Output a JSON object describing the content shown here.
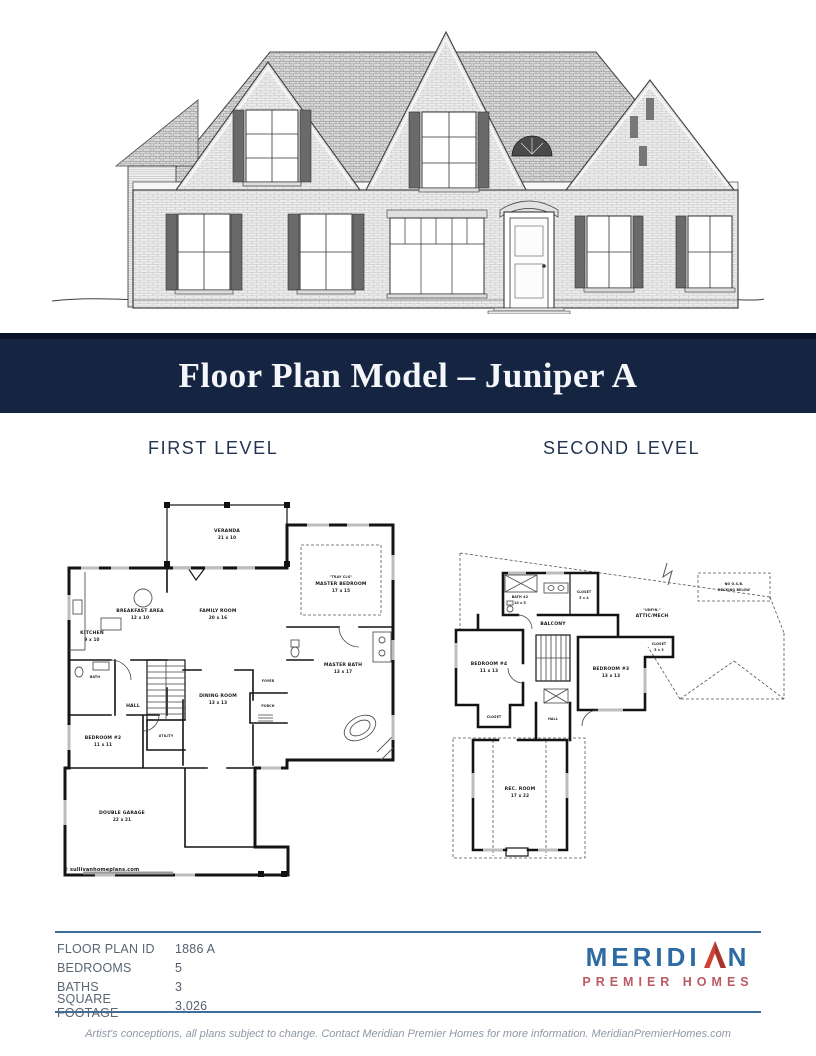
{
  "banner": {
    "title": "Floor Plan Model – Juniper A"
  },
  "section_labels": {
    "first": "FIRST LEVEL",
    "second": "SECOND LEVEL"
  },
  "first_level": {
    "rooms": [
      {
        "name": "VERANDA",
        "dims": "21 x 10"
      },
      {
        "name": "BREAKFAST AREA",
        "dims": "12 x 10"
      },
      {
        "name": "KITCHEN",
        "dims": "9 x 10"
      },
      {
        "name": "FAMILY ROOM",
        "dims": "20 x 16"
      },
      {
        "note": "\"TRAY CLG\"",
        "name": "MASTER BEDROOM",
        "dims": "17 x 15"
      },
      {
        "name": "MASTER BATH",
        "dims": "13 x 17"
      },
      {
        "name": "DINING ROOM",
        "dims": "13 x 13"
      },
      {
        "name": "HALL",
        "dims": ""
      },
      {
        "name": "UTILITY",
        "dims": ""
      },
      {
        "name": "FOYER",
        "dims": ""
      },
      {
        "name": "PORCH",
        "dims": ""
      },
      {
        "name": "BEDROOM #2",
        "dims": "11 x 11"
      },
      {
        "name": "DOUBLE GARAGE",
        "dims": "22 x 21"
      },
      {
        "name": "BATH",
        "dims": ""
      }
    ],
    "copyright": "© sullivanhomeplans.com"
  },
  "second_level": {
    "rooms": [
      {
        "name": "BATH #2",
        "dims": "10 x 5"
      },
      {
        "name": "CLOSET",
        "dims": "5 x 4"
      },
      {
        "name": "BALCONY",
        "dims": ""
      },
      {
        "name": "BEDROOM #4",
        "dims": "11 x 13"
      },
      {
        "name": "BEDROOM #3",
        "dims": "13 x 13"
      },
      {
        "name": "CLOSET",
        "dims": "5 x 3"
      },
      {
        "name": "CLOSET",
        "dims": ""
      },
      {
        "name": "HALL",
        "dims": ""
      },
      {
        "name": "REC. ROOM",
        "dims": "17 x 22"
      },
      {
        "note": "\"UNFIN.\"",
        "name": "ATTIC/MECH",
        "dims": ""
      },
      {
        "name": "NO O.S.B.",
        "dims": "DECKING BELOW"
      }
    ]
  },
  "specs": {
    "rows": [
      {
        "label": "FLOOR PLAN ID",
        "value": "1886 A"
      },
      {
        "label": "BEDROOMS",
        "value": "5"
      },
      {
        "label": "BATHS",
        "value": "3"
      },
      {
        "label": "SQUARE FOOTAGE",
        "value": "3,026"
      }
    ]
  },
  "logo": {
    "name_start": "MERIDI",
    "name_end": "N",
    "tagline": "PREMIER HOMES",
    "arrow_icon": "peak-arrow-icon",
    "brand_blue": "#2e6ba4",
    "brand_red": "#c9504a"
  },
  "disclaimer": "Artist's conceptions, all plans subject to change. Contact Meridian Premier Homes for more information. MeridianPremierHomes.com",
  "colors": {
    "banner_navy": "#152440",
    "banner_top_strip": "#081226",
    "heading_navy": "#233450",
    "rule_blue": "#3d6f9e"
  }
}
